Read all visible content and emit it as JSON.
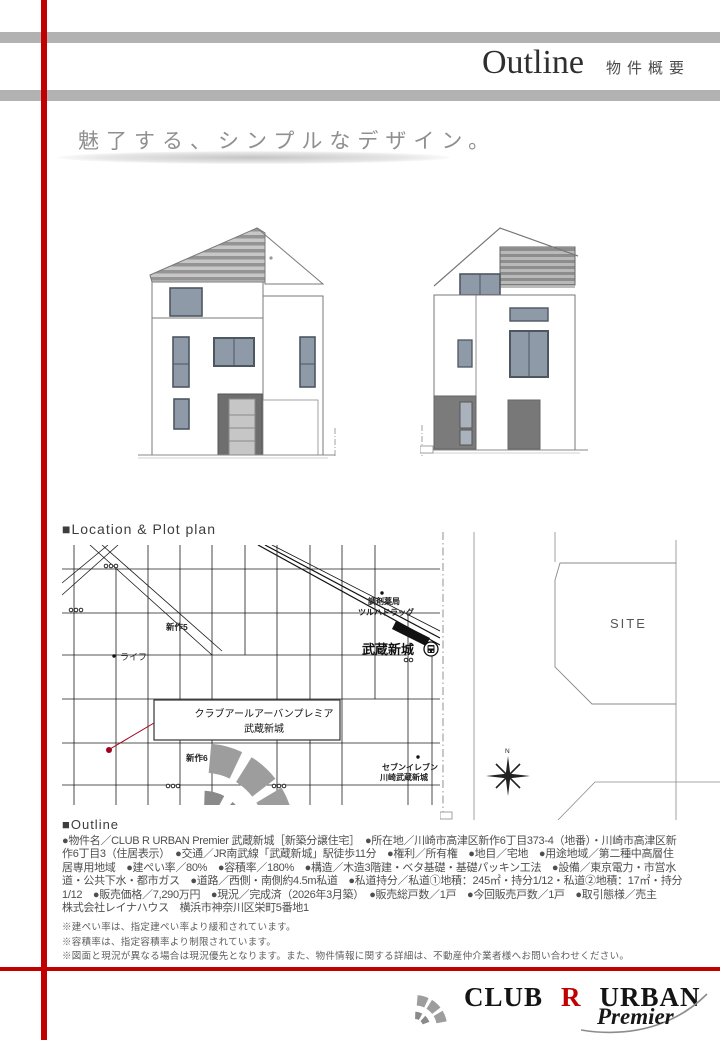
{
  "header": {
    "title_en": "Outline",
    "title_ja": "物件概要"
  },
  "tagline": "魅了する、シンプルなデザイン。",
  "location_section": {
    "heading": "■Location & Plot plan",
    "map_labels": {
      "district_shinsaku5": "新作5",
      "store_life": "ライフ",
      "pharmacy_line1": "調剤薬局",
      "pharmacy_line2": "ツルハドラッグ",
      "station_name": "武蔵新城",
      "property_line1": "クラブアールアーバンプレミア",
      "property_line2": "武蔵新城",
      "district_shinsaku6": "新作6",
      "seven_eleven_line1": "セブンイレブン",
      "seven_eleven_line2": "川崎武蔵新城"
    },
    "plot_labels": {
      "site": "SITE",
      "north": "N"
    }
  },
  "outline_section": {
    "heading": "■Outline",
    "body_lines": [
      "●物件名／CLUB R URBAN Premier 武蔵新城［新築分譲住宅］　●所在地／川崎市高津区新作6丁目373-4（地番）・川崎市高津区新",
      "作6丁目3（住居表示）　●交通／JR南武線「武蔵新城」駅徒歩11分　●権利／所有権　●地目／宅地　●用途地域／第二種中高層住",
      "居専用地域　●建ぺい率／80%　●容積率／180%　●構造／木造3階建・ベタ基礎・基礎パッキン工法　●設備／東京電力・市営水",
      "道・公共下水・都市ガス　●道路／西側・南側約4.5m私道　●私道持分／私道①地積：245㎡・持分1/12・私道②地積：17㎡・持分",
      "1/12　●販売価格／7,290万円　●現況／完成済（2026年3月築）　●販売総戸数／1戸　●今回販売戸数／1戸　●取引態様／売主",
      "株式会社レイナハウス　横浜市神奈川区栄町5番地1"
    ],
    "notes": [
      "※建ぺい率は、指定建ぺい率より緩和されています。",
      "※容積率は、指定容積率より制限されています。",
      "※図面と現況が異なる場合は現況優先となります。また、物件情報に関する詳細は、不動産仲介業者様へお問い合わせください。"
    ]
  },
  "footer": {
    "brand_club": "CLUB",
    "brand_r": "R",
    "brand_urban": "URBAN",
    "brand_premier": "Premier"
  },
  "colors": {
    "accent_red": "#c10000",
    "bar_gray": "#b2b2b2",
    "window_gray": "#8e9aa8",
    "dark_gray": "#6e6e6e"
  }
}
